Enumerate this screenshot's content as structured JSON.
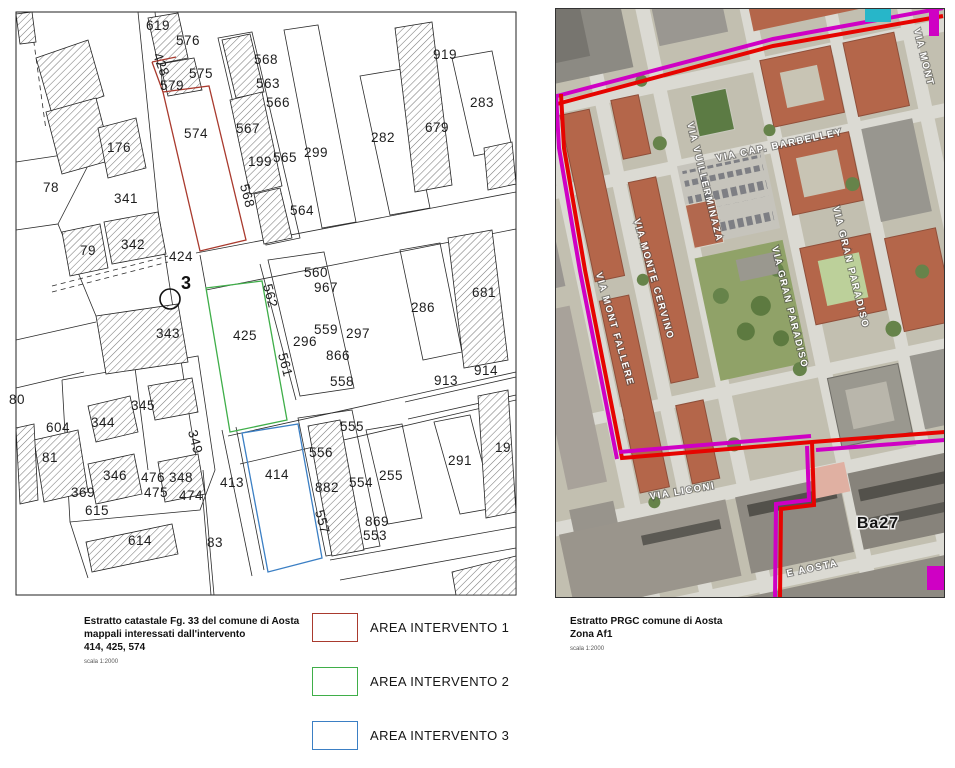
{
  "left_map": {
    "caption": {
      "line1": "Estratto catastale Fg. 33  del comune di Aosta",
      "line2": "mappali interessati dall'intervento",
      "line3": "414, 425, 574",
      "scale": "scala 1:2000"
    },
    "marker_label": "3",
    "intervention_parcels": [
      {
        "id": 1,
        "parcel": "574",
        "color": "#a93a2e"
      },
      {
        "id": 2,
        "parcel": "425",
        "color": "#3fae49"
      },
      {
        "id": 3,
        "parcel": "414",
        "color": "#3b7fc4"
      }
    ],
    "parcel_labels": [
      {
        "t": "619",
        "x": 158,
        "y": 30
      },
      {
        "t": "576",
        "x": 188,
        "y": 45
      },
      {
        "t": "428",
        "x": 157,
        "y": 66,
        "r": 70
      },
      {
        "t": "575",
        "x": 201,
        "y": 78
      },
      {
        "t": "579",
        "x": 172,
        "y": 90
      },
      {
        "t": "574",
        "x": 196,
        "y": 138,
        "s": 15
      },
      {
        "t": "568",
        "x": 266,
        "y": 64
      },
      {
        "t": "563",
        "x": 268,
        "y": 88
      },
      {
        "t": "566",
        "x": 278,
        "y": 107
      },
      {
        "t": "567",
        "x": 248,
        "y": 133
      },
      {
        "t": "199",
        "x": 260,
        "y": 166
      },
      {
        "t": "565",
        "x": 285,
        "y": 162
      },
      {
        "t": "299",
        "x": 316,
        "y": 157
      },
      {
        "t": "564",
        "x": 302,
        "y": 215
      },
      {
        "t": "568",
        "x": 243,
        "y": 197,
        "r": 75
      },
      {
        "t": "424",
        "x": 181,
        "y": 261,
        "s": 15
      },
      {
        "t": "176",
        "x": 119,
        "y": 152
      },
      {
        "t": "78",
        "x": 51,
        "y": 192
      },
      {
        "t": "341",
        "x": 126,
        "y": 203
      },
      {
        "t": "79",
        "x": 88,
        "y": 255
      },
      {
        "t": "342",
        "x": 133,
        "y": 249
      },
      {
        "t": "343",
        "x": 168,
        "y": 338
      },
      {
        "t": "80",
        "x": 17,
        "y": 404
      },
      {
        "t": "345",
        "x": 143,
        "y": 410
      },
      {
        "t": "344",
        "x": 103,
        "y": 427
      },
      {
        "t": "604",
        "x": 58,
        "y": 432
      },
      {
        "t": "81",
        "x": 50,
        "y": 462
      },
      {
        "t": "349",
        "x": 191,
        "y": 443,
        "r": 75
      },
      {
        "t": "346",
        "x": 115,
        "y": 480
      },
      {
        "t": "476",
        "x": 153,
        "y": 482
      },
      {
        "t": "348",
        "x": 181,
        "y": 482
      },
      {
        "t": "475",
        "x": 156,
        "y": 497
      },
      {
        "t": "474",
        "x": 191,
        "y": 500
      },
      {
        "t": "369",
        "x": 83,
        "y": 497
      },
      {
        "t": "615",
        "x": 97,
        "y": 515
      },
      {
        "t": "614",
        "x": 140,
        "y": 545
      },
      {
        "t": "83",
        "x": 215,
        "y": 547
      },
      {
        "t": "413",
        "x": 232,
        "y": 487,
        "s": 15
      },
      {
        "t": "414",
        "x": 277,
        "y": 479,
        "s": 15
      },
      {
        "t": "425",
        "x": 245,
        "y": 340,
        "s": 15
      },
      {
        "t": "560",
        "x": 316,
        "y": 277
      },
      {
        "t": "967",
        "x": 326,
        "y": 292
      },
      {
        "t": "559",
        "x": 326,
        "y": 334
      },
      {
        "t": "297",
        "x": 358,
        "y": 338
      },
      {
        "t": "296",
        "x": 305,
        "y": 346
      },
      {
        "t": "866",
        "x": 338,
        "y": 360
      },
      {
        "t": "558",
        "x": 342,
        "y": 386
      },
      {
        "t": "562",
        "x": 266,
        "y": 297,
        "r": 75
      },
      {
        "t": "561",
        "x": 281,
        "y": 366,
        "r": 75
      },
      {
        "t": "555",
        "x": 352,
        "y": 431
      },
      {
        "t": "556",
        "x": 321,
        "y": 457
      },
      {
        "t": "882",
        "x": 327,
        "y": 492
      },
      {
        "t": "554",
        "x": 361,
        "y": 487
      },
      {
        "t": "557",
        "x": 318,
        "y": 523,
        "r": 75
      },
      {
        "t": "869",
        "x": 377,
        "y": 526
      },
      {
        "t": "553",
        "x": 375,
        "y": 540
      },
      {
        "t": "255",
        "x": 391,
        "y": 480
      },
      {
        "t": "291",
        "x": 460,
        "y": 465
      },
      {
        "t": "19",
        "x": 503,
        "y": 452
      },
      {
        "t": "286",
        "x": 423,
        "y": 312
      },
      {
        "t": "681",
        "x": 484,
        "y": 297
      },
      {
        "t": "913",
        "x": 446,
        "y": 385
      },
      {
        "t": "914",
        "x": 486,
        "y": 375
      },
      {
        "t": "282",
        "x": 383,
        "y": 142
      },
      {
        "t": "679",
        "x": 437,
        "y": 132
      },
      {
        "t": "919",
        "x": 445,
        "y": 59
      },
      {
        "t": "283",
        "x": 482,
        "y": 107
      }
    ]
  },
  "right_map": {
    "caption": {
      "line1": "Estratto PRGC comune di Aosta",
      "line2": "Zona Af1",
      "scale": "scala 1:2000"
    },
    "zone_label": "Ba27",
    "boundary_colors": {
      "red": "#e60400",
      "magenta": "#cf00c4",
      "cyan": "#27b6c9"
    },
    "street_labels": [
      {
        "t": "VIA CAP. BARBELLEY",
        "x": 225,
        "y": 140,
        "r": -12
      },
      {
        "t": "VIA GRAN PARADISO",
        "x": 293,
        "y": 260,
        "r": 76
      },
      {
        "t": "VIA GRAN PARADISO",
        "x": 232,
        "y": 300,
        "r": 76
      },
      {
        "t": "VIA VUILLERMINAZA",
        "x": 147,
        "y": 175,
        "r": 76
      },
      {
        "t": "VIA MONTE CERVINO",
        "x": 96,
        "y": 272,
        "r": 74
      },
      {
        "t": "VIA MONT FALLERE",
        "x": 57,
        "y": 322,
        "r": 74
      },
      {
        "t": "VIA LICONI",
        "x": 128,
        "y": 486,
        "r": -10
      },
      {
        "t": "VIA MONT",
        "x": 366,
        "y": 50,
        "r": 76
      },
      {
        "t": "E AOSTA",
        "x": 258,
        "y": 563,
        "r": -12
      }
    ]
  },
  "legend": {
    "items": [
      {
        "label": "AREA INTERVENTO 1",
        "color": "#a93a2e"
      },
      {
        "label": "AREA INTERVENTO 2",
        "color": "#3fae49"
      },
      {
        "label": "AREA INTERVENTO 3",
        "color": "#3b7fc4"
      }
    ]
  }
}
